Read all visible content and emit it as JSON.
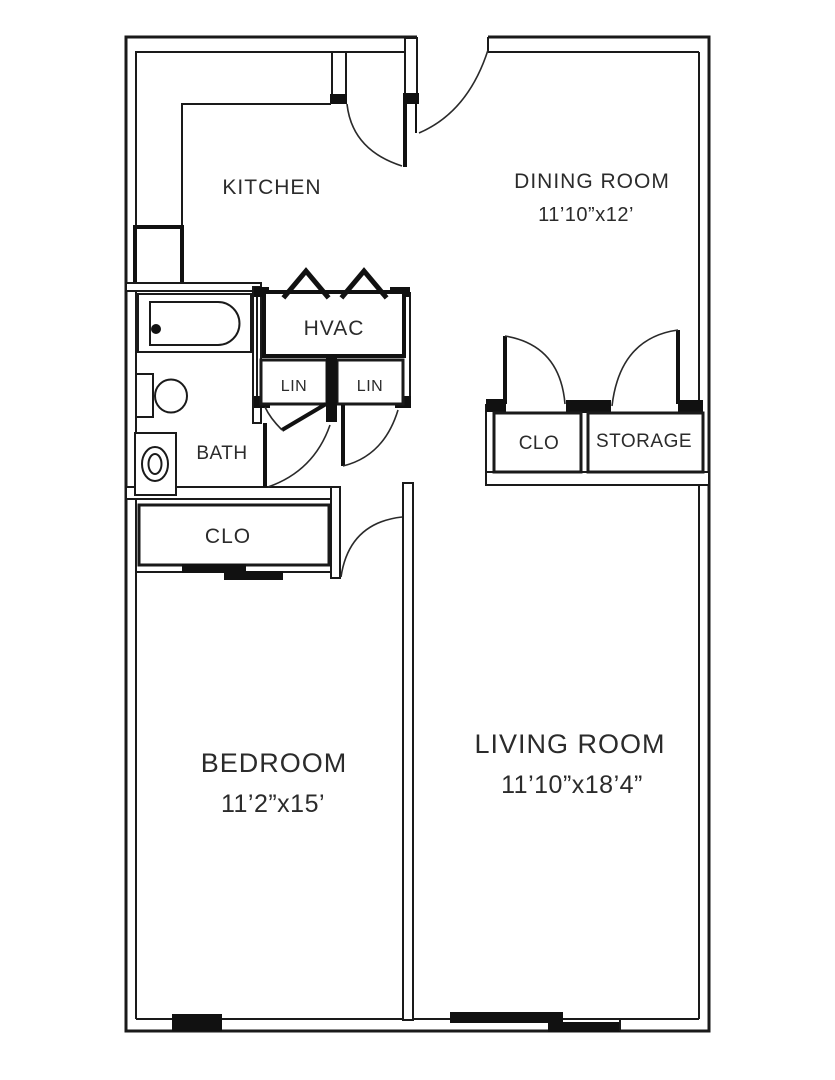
{
  "floorplan": {
    "type": "apartment-floor-plan",
    "colors": {
      "line": "#1a1a1a",
      "background": "#ffffff",
      "text": "#2b2b2b"
    },
    "rooms": {
      "kitchen": {
        "label": "KITCHEN"
      },
      "dining": {
        "label": "DINING ROOM",
        "dimensions": "11’10”x12’"
      },
      "hvac": {
        "label": "HVAC"
      },
      "linen_left": {
        "label": "LIN"
      },
      "linen_right": {
        "label": "LIN"
      },
      "bath": {
        "label": "BATH"
      },
      "closet_hall": {
        "label": "CLO"
      },
      "storage": {
        "label": "STORAGE"
      },
      "closet_bedroom": {
        "label": "CLO"
      },
      "bedroom": {
        "label": "BEDROOM",
        "dimensions": "11’2”x15’"
      },
      "living": {
        "label": "LIVING ROOM",
        "dimensions": "11’10”x18’4”"
      }
    },
    "fixtures": {
      "bathtub": "bathtub with drain",
      "toilet": "toilet",
      "sink": "pedestal sink",
      "refrigerator": "refrigerator",
      "kitchen_counter": "L-shaped counter",
      "hvac_doors": "bifold louver doors",
      "bedroom_closet_door": "sliding bypass doors",
      "bedroom_window": "window",
      "living_patio_door": "sliding glass door"
    }
  }
}
